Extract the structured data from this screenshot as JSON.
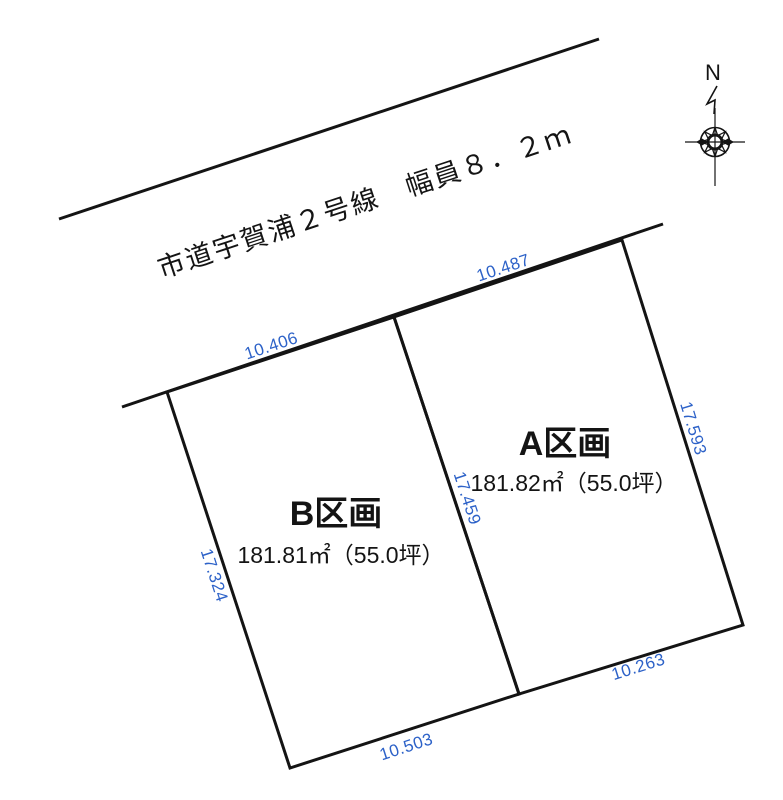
{
  "road": {
    "label": "市道宇賀浦２号線　幅員８．２ｍ"
  },
  "compass": {
    "north_label": "N"
  },
  "plots": [
    {
      "name": "A区画",
      "area": "181.82㎡（55.0坪）",
      "dimensions": {
        "frontage": "10.487",
        "right": "17.593",
        "bottom": "10.263",
        "left": "17.459"
      }
    },
    {
      "name": "B区画",
      "area": "181.81㎡（55.0坪）",
      "dimensions": {
        "frontage": "10.406",
        "left": "17.324",
        "bottom": "10.503"
      }
    }
  ],
  "colors": {
    "line": "#141414",
    "text": "#141414",
    "dimension": "#2d62c8"
  }
}
